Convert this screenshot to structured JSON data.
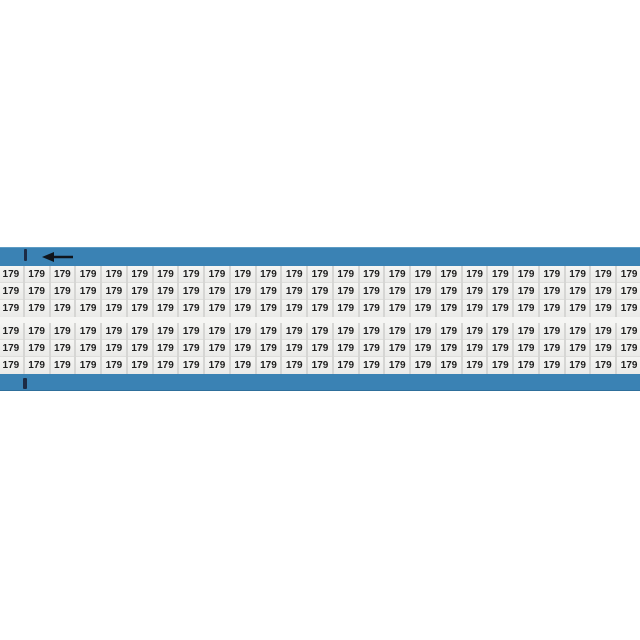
{
  "product": {
    "type": "wire-marker-card",
    "label_text": "179",
    "total_labels": 150,
    "rows": 6,
    "columns": 25,
    "row_groups": 2,
    "rows_per_group": 3
  },
  "icons": {
    "arrow": {
      "name": "left-arrow-icon",
      "direction": "left"
    },
    "ticks": [
      "alignment-tick-top",
      "alignment-tick-bottom"
    ]
  },
  "colors": {
    "page_bg": "#ffffff",
    "card_blue": "#3a82b4",
    "card_blue_edge": "#2e6f9b",
    "gutter": "#d6d6d4",
    "cell_bg": "#f1f1ef",
    "group_gap": "#f5f5f3",
    "label_text": "#1f1f1f",
    "tick": "#1c2b45",
    "arrow": "#10151c"
  }
}
